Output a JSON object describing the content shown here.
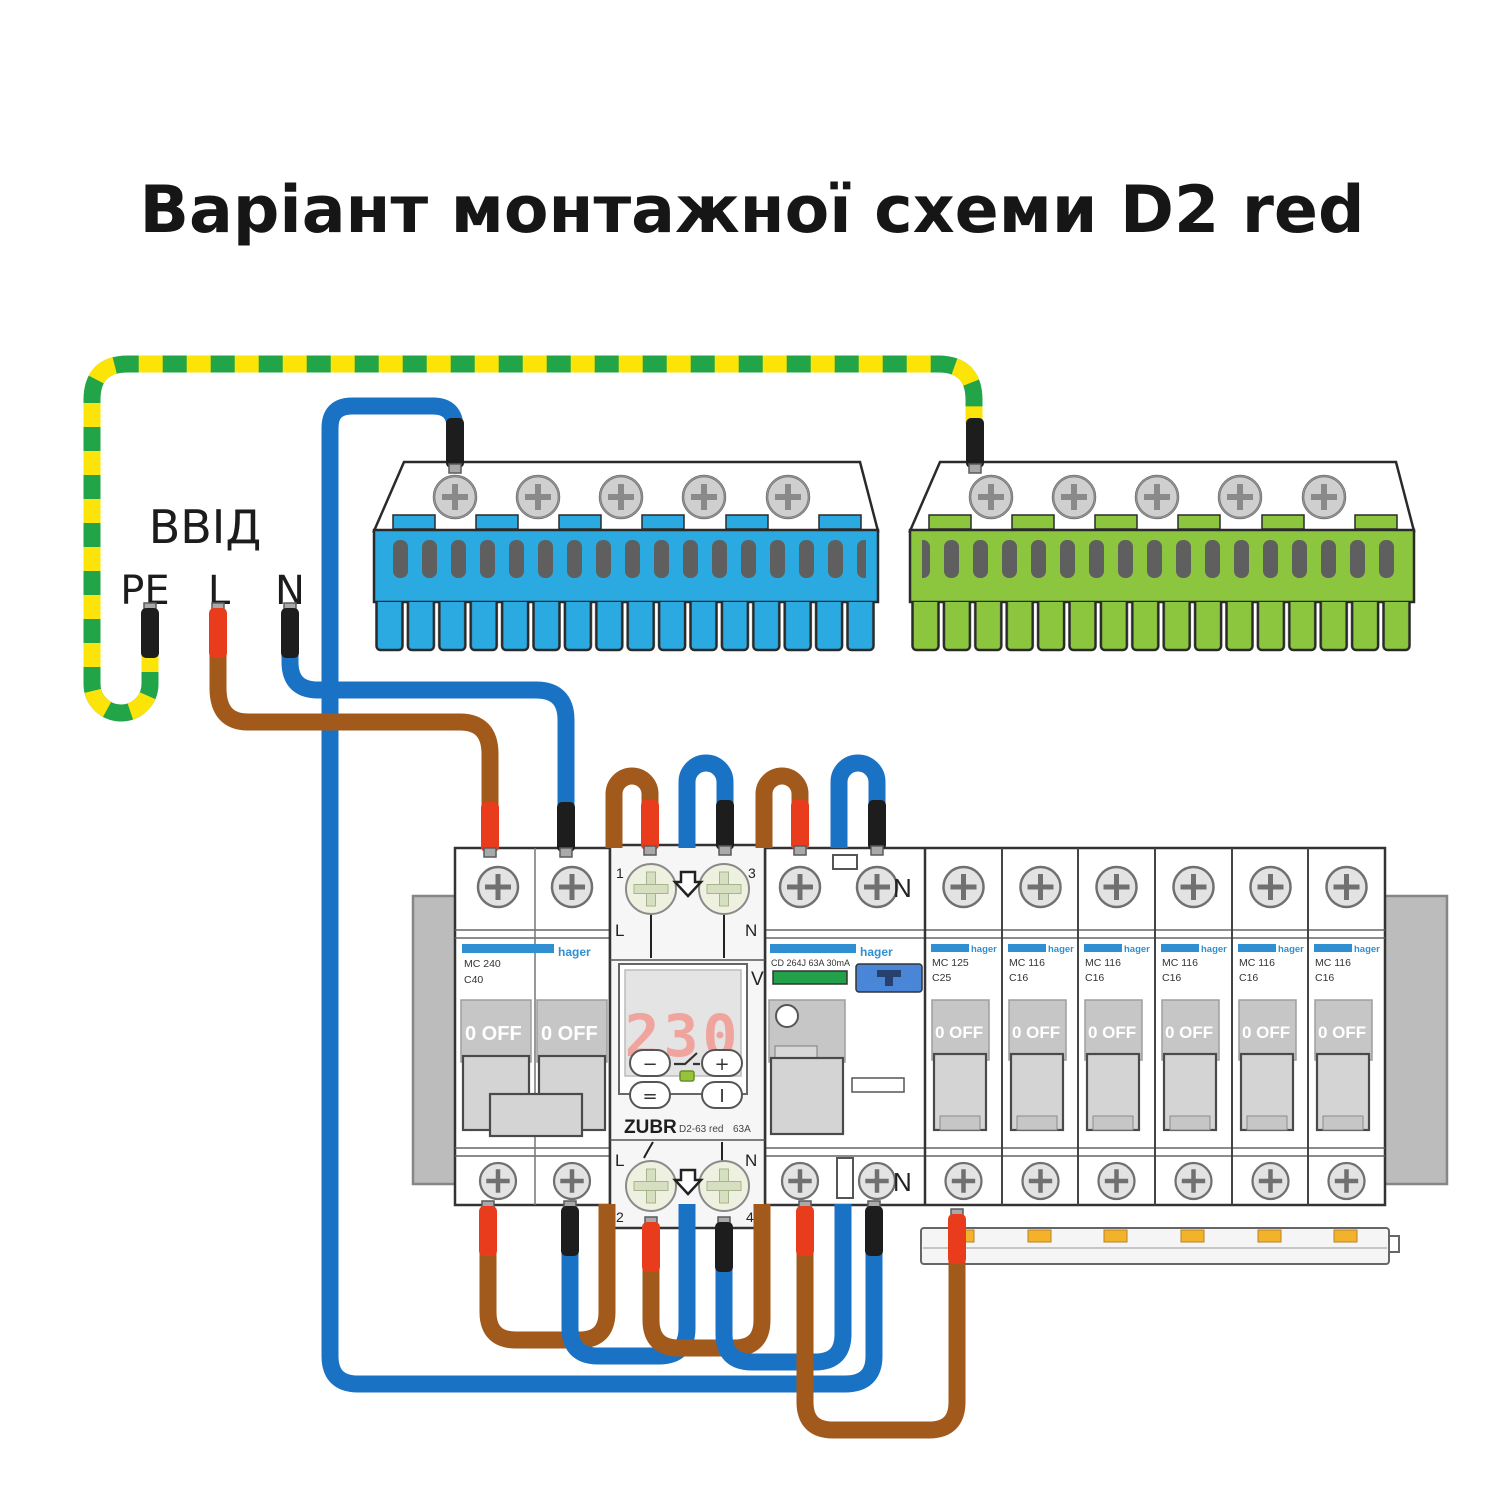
{
  "title": "Варіант монтажної схеми D2 red",
  "input_block": {
    "label": "ВВІД",
    "pe": "PE",
    "l": "L",
    "n": "N"
  },
  "colors": {
    "wire_blue": "#1a72c4",
    "wire_brown": "#a2591c",
    "tip_red": "#e83c1c",
    "tip_black": "#1d1d1d",
    "pe_green": "#22a449",
    "pe_yellow": "#fde408",
    "busbar_blue": "#2ba9e1",
    "busbar_green": "#8cc63e",
    "brand_blue": "#2f8fd0",
    "led_green": "#97c23c",
    "display_digits": "#f0a49e",
    "comb_clip_yellow": "#f2b32b"
  },
  "left_breaker": {
    "brand": "hager",
    "model": "MC 240",
    "rating": "C40",
    "toggle": "0 OFF"
  },
  "relay": {
    "brand": "ZUBR",
    "model": "D2-63 red",
    "current": "63A",
    "display_value": "230",
    "display_unit": "V",
    "terminal_1": "1",
    "terminal_2": "2",
    "terminal_3": "3",
    "terminal_4": "4",
    "l_label": "L",
    "n_label": "N",
    "btn_minus": "−",
    "btn_plus": "+",
    "btn_menu": "=",
    "btn_power": "I"
  },
  "rcd": {
    "brand": "hager",
    "model": "CD 264J 63A 30mA",
    "n_label": "N"
  },
  "mcbs": [
    {
      "brand": "hager",
      "model": "MC 125",
      "rating": "C25",
      "toggle": "0 OFF"
    },
    {
      "brand": "hager",
      "model": "MC 116",
      "rating": "C16",
      "toggle": "0 OFF"
    },
    {
      "brand": "hager",
      "model": "MC 116",
      "rating": "C16",
      "toggle": "0 OFF"
    },
    {
      "brand": "hager",
      "model": "MC 116",
      "rating": "C16",
      "toggle": "0 OFF"
    },
    {
      "brand": "hager",
      "model": "MC 116",
      "rating": "C16",
      "toggle": "0 OFF"
    },
    {
      "brand": "hager",
      "model": "MC 116",
      "rating": "C16",
      "toggle": "0 OFF"
    }
  ]
}
